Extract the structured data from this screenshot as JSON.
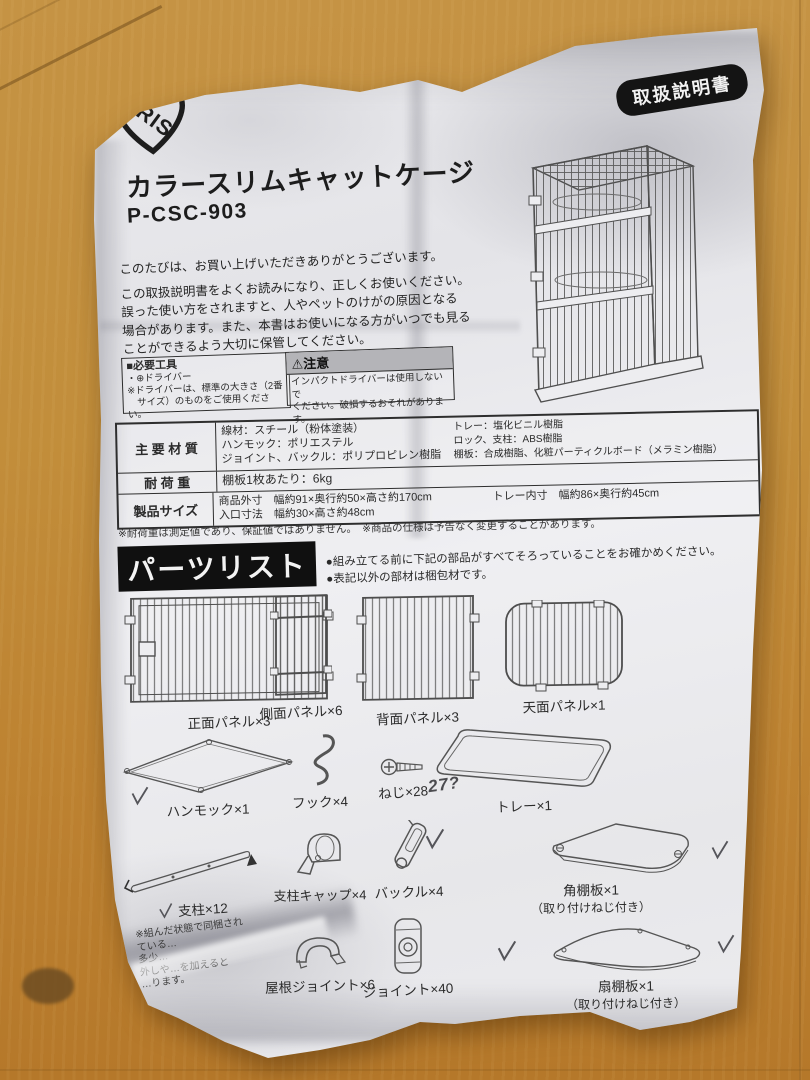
{
  "colors": {
    "wood": "#c28e3b",
    "paper": "#e9e9ec",
    "ink": "#2b2b2b",
    "badge_bg": "#141414",
    "caution_header_bg": "#b4b4b8"
  },
  "badge": {
    "label": "取扱説明書"
  },
  "logo": {
    "text": "IRIS"
  },
  "title": "カラースリムキャットケージ",
  "model": "P-CSC-903",
  "intro": [
    "このたびは、お買い上げいただきありがとうございます。",
    "この取扱説明書をよくお読みになり、正しくお使いください。",
    "誤った使い方をされますと、人やペットのけがの原因となる",
    "場合があります。また、本書はお使いになる方がいつでも見る",
    "ことができるよう大切に保管してください。"
  ],
  "tools_box": {
    "title": "■必要工具",
    "lines": [
      "・⊕ドライバー",
      "※ドライバーは、標準の大きさ（2番",
      "　サイズ）のものをご使用ください。"
    ]
  },
  "caution_box": {
    "icon": "⚠",
    "title": "注意",
    "lines": [
      "インパクトドライバーは使用しないで",
      "ください。破損するおそれがあります。"
    ]
  },
  "spec_table": {
    "rows": [
      {
        "label": "主 要 材 質",
        "left": [
          "線材：スチール（粉体塗装）",
          "ハンモック：ポリエステル",
          "ジョイント、バックル：ポリプロピレン樹脂"
        ],
        "right": [
          "トレー：塩化ビニル樹脂",
          "ロック、支柱：ABS樹脂",
          "棚板：合成樹脂、化粧パーティクルボード（メラミン樹脂）"
        ]
      },
      {
        "label": "耐 荷 重",
        "left": [
          "棚板1枚あたり：6kg"
        ],
        "right": []
      },
      {
        "label": "製品サイズ",
        "left": [
          "商品外寸　幅約91×奥行約50×高さ約170cm",
          "入口寸法　幅約30×高さ約48cm"
        ],
        "right": [
          "トレー内寸　幅約86×奥行約45cm"
        ]
      }
    ]
  },
  "footnotes": "※耐荷重は測定値であり、保証値ではありません。　※商品の仕様は予告なく変更することがあります。",
  "parts_header": {
    "title": "パーツリスト",
    "bullets": [
      "●組み立てる前に下記の部品がすべてそろっていることをお確かめください。",
      "●表記以外の部材は梱包材です。"
    ]
  },
  "parts": {
    "front_panel": "正面パネル×3",
    "side_panel": "側面パネル×6",
    "back_panel": "背面パネル×3",
    "top_panel": "天面パネル×1",
    "hammock": "ハンモック×1",
    "hook": "フック×4",
    "screw": "ねじ×28",
    "tray": "トレー×1",
    "pillar": "支柱×12",
    "pillar_note": [
      "※組んだ状態で同梱され",
      "ている…",
      "多少…",
      "外しや…を加えると",
      "…ります。"
    ],
    "pillar_cap": "支柱キャップ×4",
    "buckle": "バックル×4",
    "corner_shelf": "角棚板×1",
    "corner_shelf_sub": "（取り付けねじ付き）",
    "roof_joint": "屋根ジョイント×6",
    "joint": "ジョイント×40",
    "fan_shelf": "扇棚板×1",
    "fan_shelf_sub": "（取り付けねじ付き）"
  },
  "handwritten": {
    "screw_count": "27?",
    "checkmarks": 6
  }
}
